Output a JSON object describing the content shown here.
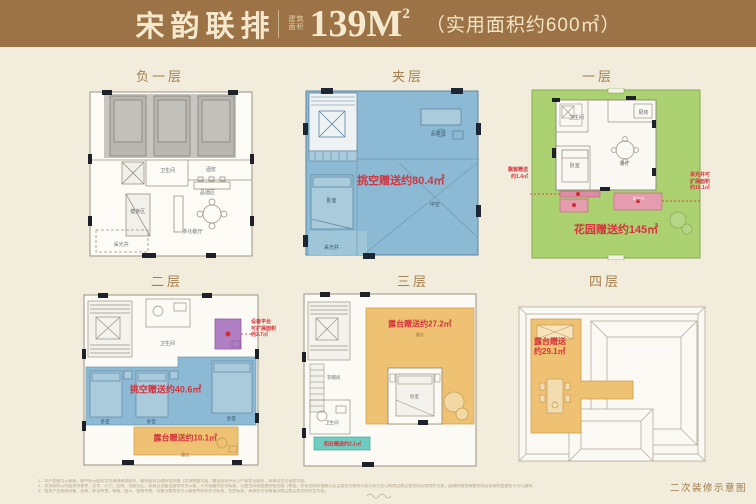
{
  "header": {
    "title": "宋韵联排",
    "area_small_1": "建筑",
    "area_small_2": "面积",
    "area_value": "139M",
    "area_sup": "2",
    "usable": "（实用面积约600㎡）"
  },
  "colors": {
    "header_bg": "#9c7347",
    "background": "#f1ecdb",
    "blue_fill": "#8cb9d3",
    "green_fill": "#acd171",
    "orange_fill": "#efc172",
    "teal_fill": "#6fccc0",
    "purple_fill": "#b07ec2",
    "pink_fill": "#e59cae",
    "red_text": "#d5343d",
    "label_brown": "#a5804f"
  },
  "floor_labels": {
    "b1": "负一层",
    "mezz": "夹层",
    "f1": "一层",
    "f2": "二层",
    "f3": "三层",
    "f4": "四层"
  },
  "b1": {
    "rooms": {
      "bath": "卫生间",
      "cellar": "酒窖",
      "tasting": "品酒区",
      "gym": "健身区",
      "hall": "多功能厅",
      "lightwell": "采光井"
    }
  },
  "mezz": {
    "gift": "挑空赠送约80.4㎡",
    "rooms": {
      "tea": "品茶区",
      "bed": "卧室",
      "void": "中空",
      "lightwell": "采光井"
    }
  },
  "f1": {
    "gift": "花园赠送约145㎡",
    "ann_left": [
      "飘窗赠送",
      "约1.4㎡"
    ],
    "ann_right": [
      "采光井可",
      "扩展面积",
      "约10.1㎡"
    ],
    "rooms": {
      "bath": "卫生间",
      "kitchen": "厨房",
      "bed": "卧室",
      "dining": "餐厅",
      "lightwell": "采光井"
    }
  },
  "f2": {
    "gift": "挑空赠送约40.6㎡",
    "terrace_gift": "露台赠送约10.1㎡",
    "ann_right": [
      "设备平台",
      "可扩展面积",
      "约2.7㎡"
    ],
    "rooms": {
      "bath": "卫生间",
      "bed": "卧室",
      "terrace": "露台"
    }
  },
  "f3": {
    "terrace_gift": "露台赠送约27.2㎡",
    "balcony_gift": "阳台赠送约2.1㎡",
    "rooms": {
      "cloak": "衣帽间",
      "bath": "卫生间",
      "bed": "卧室",
      "terrace": "露台"
    }
  },
  "f4": {
    "terrace_gift_l1": "露台赠送",
    "terrace_gift_l2": "约29.1㎡"
  },
  "footer": {
    "note": "二次装修示意图",
    "disclaimers": [
      "1、本户型图为示意图，图中所示面积均为预测建筑面积，最终面积以政府相关部门实测数据为准，赠送面积不计入产权登记面积，具体以交付现状为准。",
      "2、本资料所示内容仅供参考，文字、尺寸、比例、功能分区、家具及设备设施等均为示意，不代表最终交付标准，可变空间改造需经相关部门审批，对本资料的理解以及买卖双方权利义务以双方签订的商品房买卖合同及其附件为准，因政府规划调整等原因导致的变更恕不另行通知。",
      "3、相关户型装修风格、家具、陈设布置、绿植、图示、管线布置、设备位置等仅为示意参考而非交付标准，交房标准、具体交付详情请以商品房买卖合同约定为准。"
    ]
  }
}
